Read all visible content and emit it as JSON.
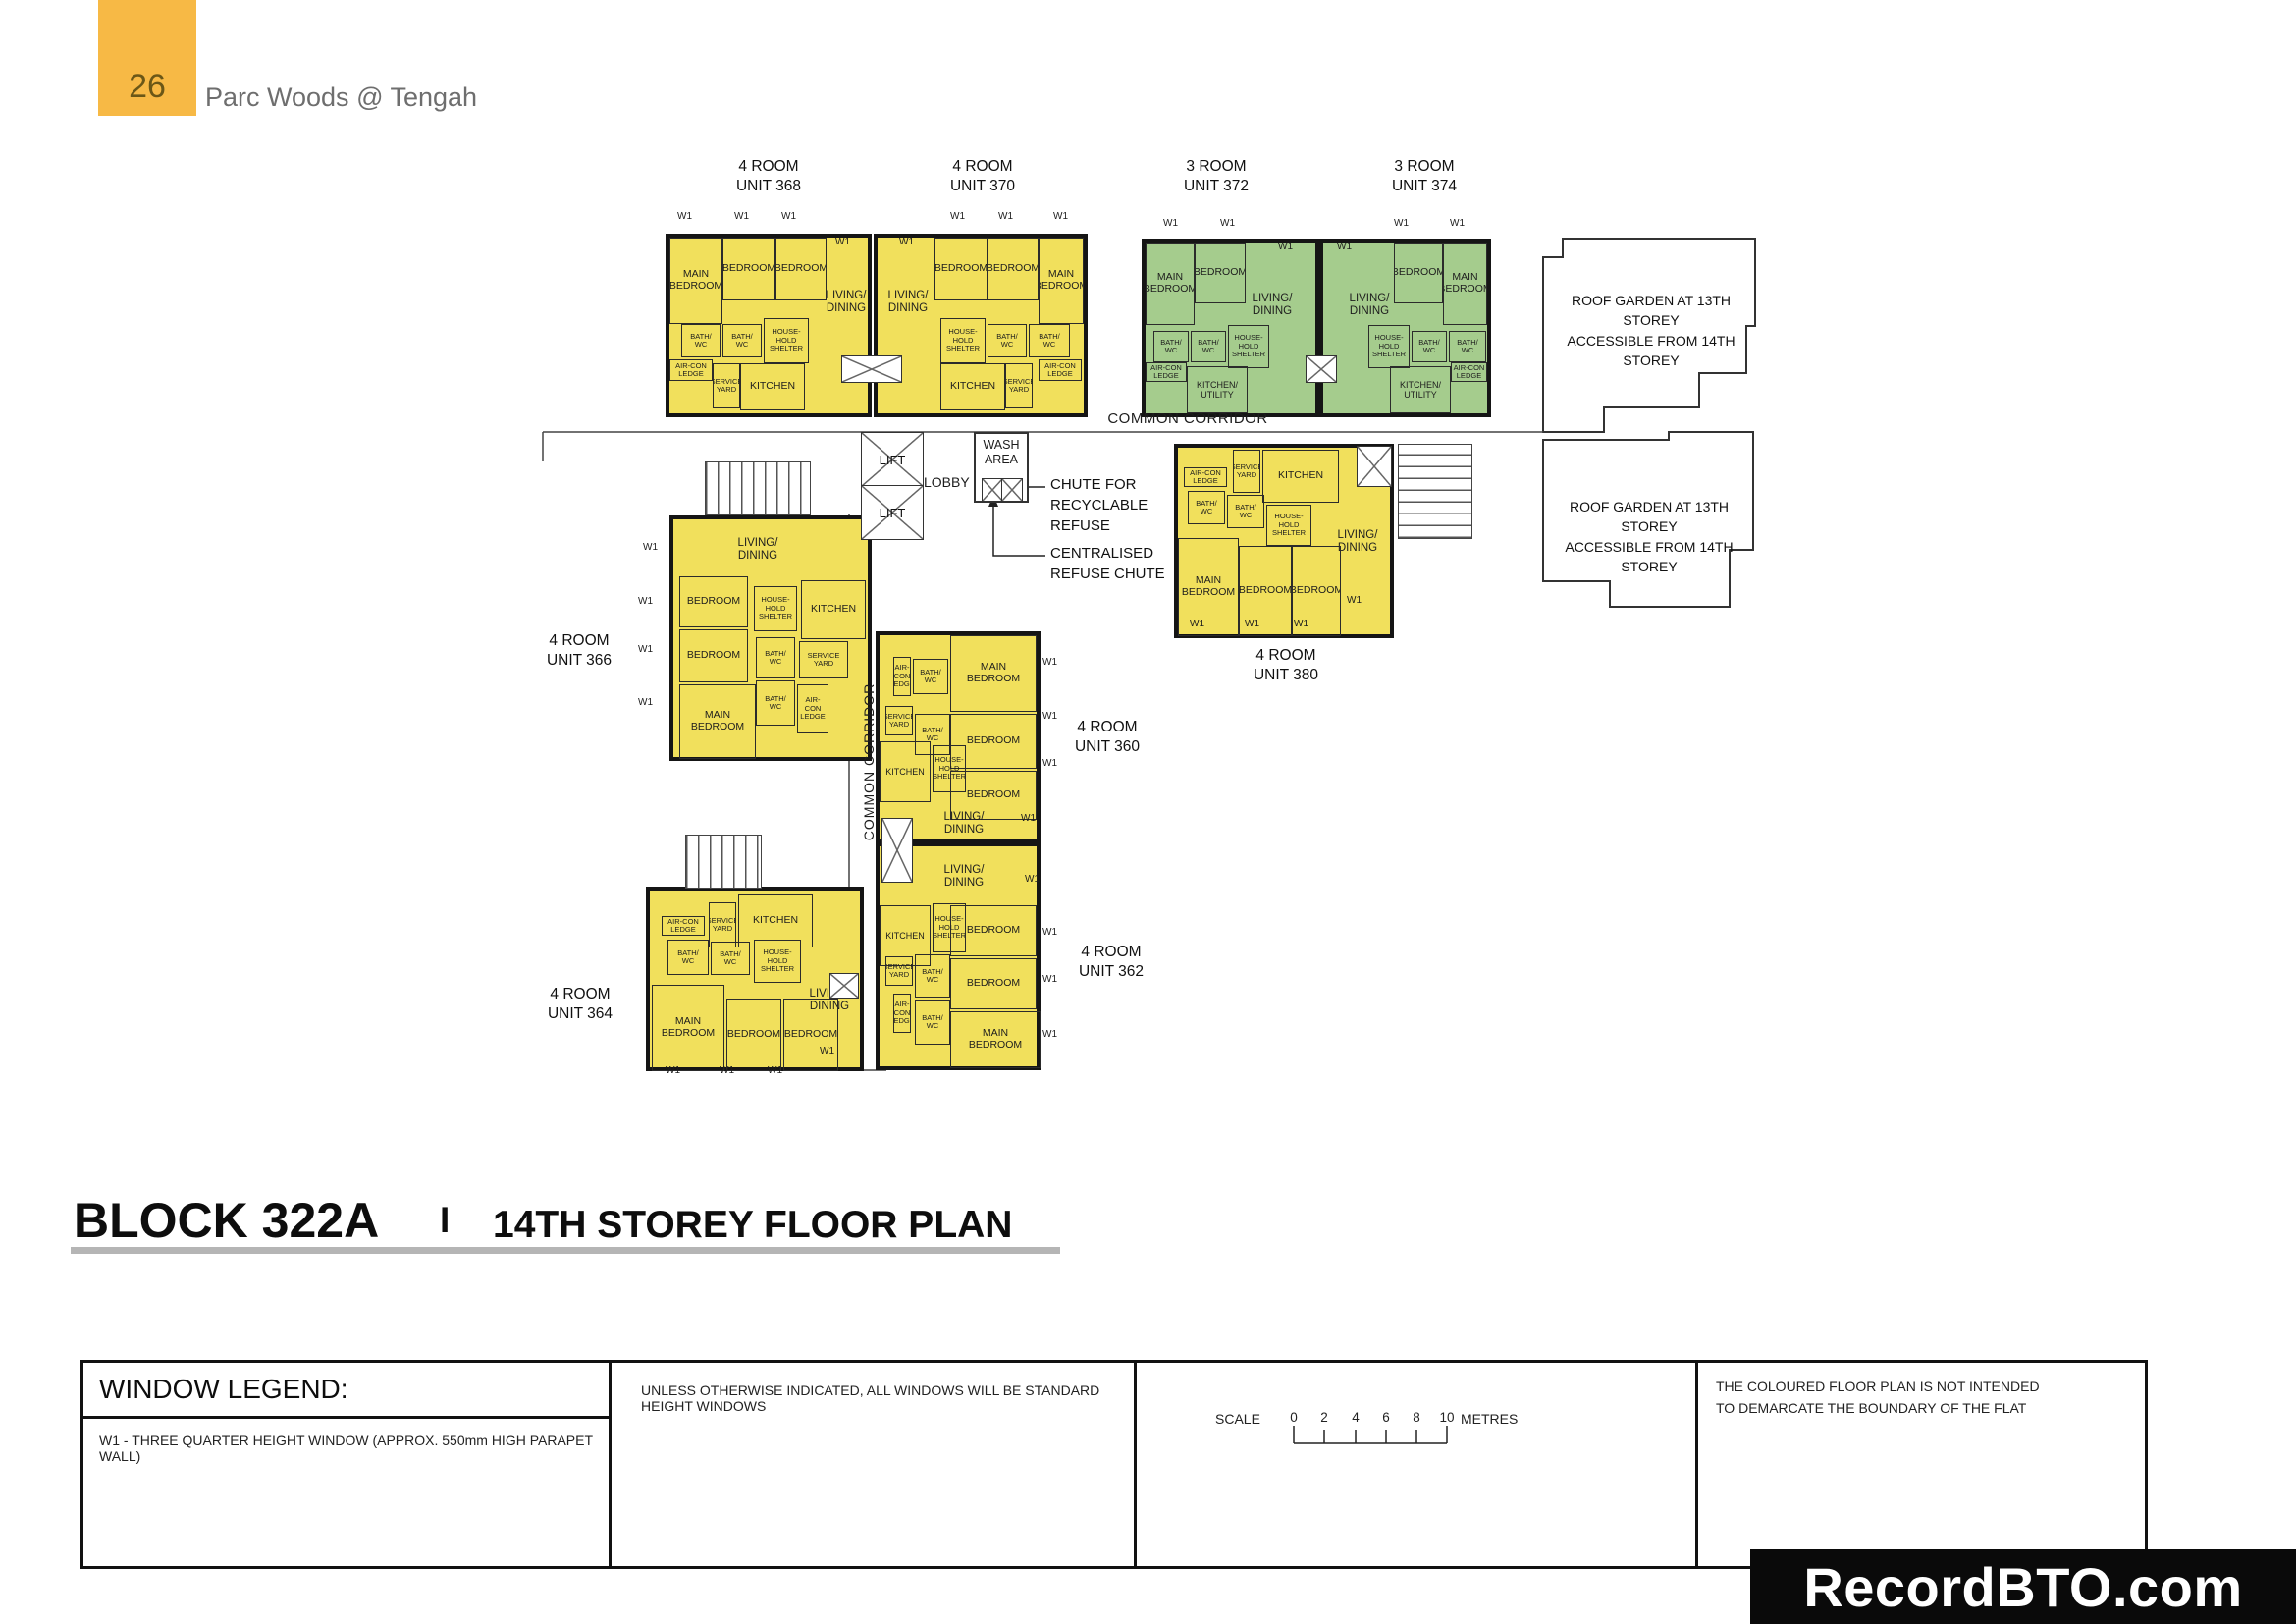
{
  "header": {
    "page_number": "26",
    "project_title": "Parc Woods @ Tengah"
  },
  "plan": {
    "common_corridor": "COMMON CORRIDOR",
    "lift": "LIFT",
    "lobby": "LOBBY",
    "wash_area": "WASH\nAREA",
    "chute_recyclable": "CHUTE FOR\nRECYCLABLE\nREFUSE",
    "centralised_chute": "CENTRALISED\nREFUSE CHUTE",
    "roof_garden": "ROOF GARDEN AT 13TH STOREY\nACCESSIBLE FROM 14TH STOREY",
    "window_label": "W1"
  },
  "room_names": {
    "main_bedroom": "MAIN\nBEDROOM",
    "bedroom": "BEDROOM",
    "living_dining": "LIVING/\nDINING",
    "bath_wc": "BATH/\nWC",
    "household_shelter": "HOUSE-\nHOLD\nSHELTER",
    "kitchen": "KITCHEN",
    "kitchen_utility": "KITCHEN/\nUTILITY",
    "service_yard": "SERVICE\nYARD",
    "aircon_ledge": "AIR-CON\nLEDGE"
  },
  "units": [
    {
      "id": "368",
      "type_label": "4 ROOM",
      "unit_label": "UNIT 368"
    },
    {
      "id": "370",
      "type_label": "4 ROOM",
      "unit_label": "UNIT 370"
    },
    {
      "id": "372",
      "type_label": "3 ROOM",
      "unit_label": "UNIT 372"
    },
    {
      "id": "374",
      "type_label": "3 ROOM",
      "unit_label": "UNIT 374"
    },
    {
      "id": "380",
      "type_label": "4 ROOM",
      "unit_label": "UNIT 380"
    },
    {
      "id": "366",
      "type_label": "4 ROOM",
      "unit_label": "UNIT 366"
    },
    {
      "id": "360",
      "type_label": "4 ROOM",
      "unit_label": "UNIT 360"
    },
    {
      "id": "362",
      "type_label": "4 ROOM",
      "unit_label": "UNIT 362"
    },
    {
      "id": "364",
      "type_label": "4 ROOM",
      "unit_label": "UNIT 364"
    }
  ],
  "title_bar": {
    "block": "BLOCK 322A",
    "divider": "I",
    "title": "14TH STOREY FLOOR PLAN"
  },
  "legend": {
    "window_legend_title": "WINDOW LEGEND:",
    "w1_entry": "W1  -  THREE QUARTER HEIGHT WINDOW (APPROX. 550mm HIGH PARAPET WALL)",
    "windows_note": "UNLESS OTHERWISE INDICATED,  ALL WINDOWS WILL BE STANDARD HEIGHT WINDOWS",
    "scale_label": "SCALE",
    "scale_ticks": [
      "0",
      "2",
      "4",
      "6",
      "8",
      "10"
    ],
    "scale_unit": "METRES",
    "disclaimer": "THE COLOURED FLOOR PLAN IS NOT INTENDED\nTO DEMARCATE THE BOUNDARY OF THE FLAT"
  },
  "watermark": "RecordBTO.com",
  "colors": {
    "four_room_fill": "#F1E05C",
    "three_room_fill": "#A5CC8D",
    "header_badge": "#F7B945",
    "wall": "#151515",
    "banner_bg": "#0a0a0a"
  }
}
